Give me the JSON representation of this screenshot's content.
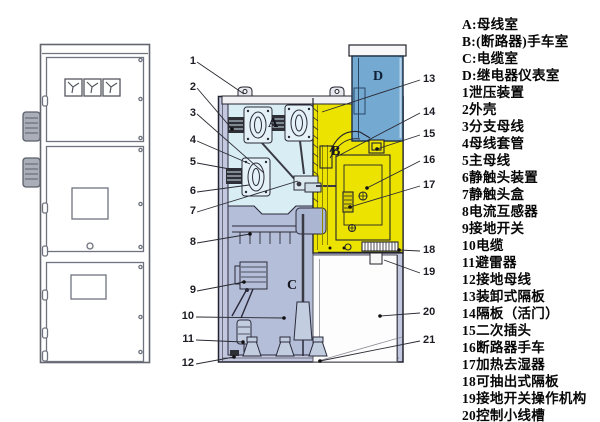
{
  "legend": {
    "items": [
      "A:母线室",
      "B:(断路器)手车室",
      "C:电缆室",
      "D:继电器仪表室",
      "1泄压装置",
      "2外壳",
      "3分支母线",
      "4母线套管",
      "5主母线",
      "6静触头装置",
      "7静触头盒",
      "8电流互感器",
      "9接地开关",
      "10电缆",
      "11避雷器",
      "12接地母线",
      "13装卸式隔板",
      "14隔板（活门）",
      "15二次插头",
      "16断路器手车",
      "17加热去湿器",
      "18可抽出式隔板",
      "19接地开关操作机构",
      "20控制小线槽"
    ]
  },
  "diagram": {
    "rooms": {
      "a": "A",
      "b": "B",
      "c": "C",
      "d": "D"
    },
    "callouts": [
      "1",
      "2",
      "3",
      "4",
      "5",
      "6",
      "7",
      "8",
      "9",
      "10",
      "11",
      "12",
      "13",
      "14",
      "15",
      "16",
      "17",
      "18",
      "19",
      "20",
      "21"
    ]
  },
  "colors": {
    "casing": "#c3c8e0",
    "room_a": "#d9edf4",
    "room_b": "#ece400",
    "room_c": "#b4bed8",
    "room_d": "#74aad2",
    "line": "#23232e"
  }
}
